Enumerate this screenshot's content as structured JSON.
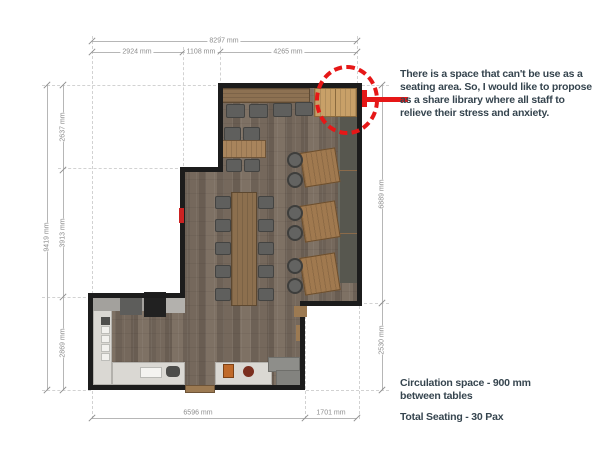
{
  "plan": {
    "note": "There is a space that can't be use as a seating area. So, I would like to propose as a share library where all staff to relieve their stress and anxiety.",
    "circulation_note": "Circulation space - 900 mm between tables",
    "seating_note": "Total Seating - 30 Pax"
  },
  "dimensions": {
    "top": {
      "total": "8297 mm",
      "segments": [
        "2924 mm",
        "1108 mm",
        "4265 mm"
      ]
    },
    "left": {
      "total": "9419 mm",
      "segments": [
        "2637 mm",
        "3913 mm",
        "2869 mm"
      ]
    },
    "right": {
      "segments": [
        "6889 mm",
        "2530 mm"
      ]
    },
    "bottom": {
      "segments": [
        "6596 mm",
        "1701 mm"
      ]
    }
  },
  "colors": {
    "highlight_red": "#e61717",
    "note_ink": "#36454f",
    "wall_black": "#1c1c1c",
    "dim_gray": "#8c8c8c"
  }
}
